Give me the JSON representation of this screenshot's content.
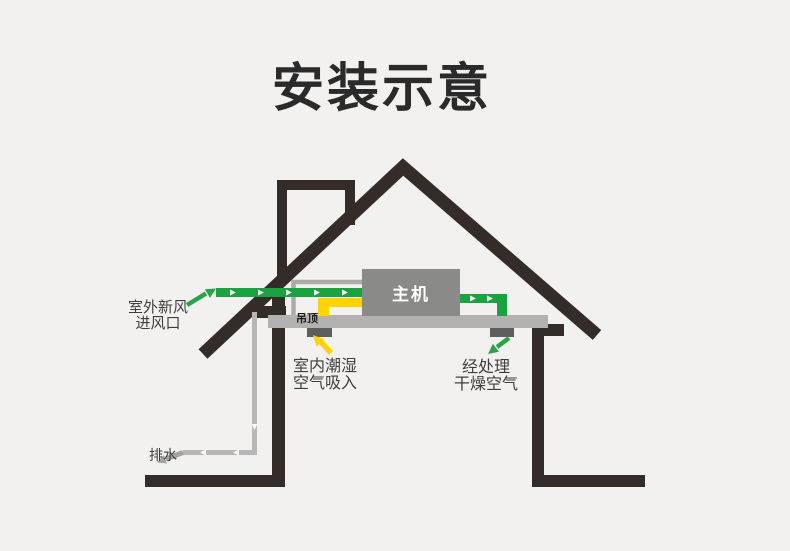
{
  "title": "安装示意",
  "diagram": {
    "main_unit_label": "主机",
    "ceiling_label": "吊顶",
    "labels": {
      "outdoor_fresh_air": [
        "室外新风",
        "进风口"
      ],
      "indoor_humid_air": [
        "室内潮湿",
        "空气吸入"
      ],
      "processed_dry_air": [
        "经处理",
        "干燥空气"
      ],
      "drain": "排水"
    },
    "flows": [
      {
        "name": "outdoor-fresh-air-inlet",
        "color": "#18a33e",
        "direction": "into house toward main unit"
      },
      {
        "name": "indoor-humid-air-intake",
        "color": "#ffd400",
        "direction": "up from ceiling vent into main unit"
      },
      {
        "name": "processed-dry-air-outlet",
        "color": "#18a33e",
        "direction": "down from main unit through ceiling vent"
      },
      {
        "name": "drain-water",
        "color": "#b6b6b6",
        "direction": "down the wall and out at floor level"
      }
    ]
  },
  "colors": {
    "background": "#f2f1ef",
    "structure": "#332c28",
    "fresh_air_green": "#18a33e",
    "humid_air_yellow": "#ffd400",
    "ceiling_gray": "#b3b2b0",
    "unit_gray": "#8a8a88",
    "vent_gray": "#5e5e5e",
    "pipe_gray": "#b6b6b6",
    "label_text": "#3e3e3e",
    "title_text": "#2a2a2a"
  }
}
